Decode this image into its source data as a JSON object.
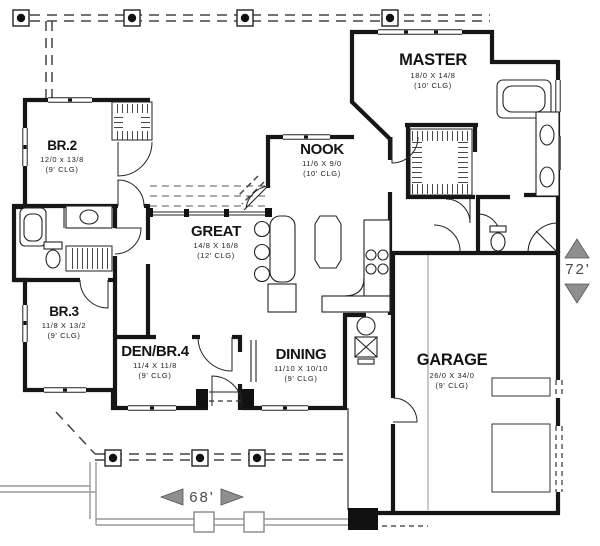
{
  "rooms": [
    {
      "id": "master",
      "name": "MASTER",
      "dims": "18/0 X 14/8",
      "clg": "(10' CLG)"
    },
    {
      "id": "nook",
      "name": "NOOK",
      "dims": "11/6 X 9/0",
      "clg": "(10' CLG)"
    },
    {
      "id": "br2",
      "name": "BR.2",
      "dims": "12/0 x 13/8",
      "clg": "(9' CLG)"
    },
    {
      "id": "great",
      "name": "GREAT",
      "dims": "14/8 X 16/8",
      "clg": "(12' CLG)"
    },
    {
      "id": "br3",
      "name": "BR.3",
      "dims": "11/8 X 13/2",
      "clg": "(9' CLG)"
    },
    {
      "id": "den",
      "name": "DEN/BR.4",
      "dims": "11/4 X 11/8",
      "clg": "(9' CLG)"
    },
    {
      "id": "dining",
      "name": "DINING",
      "dims": "11/10 X 10/10",
      "clg": "(9' CLG)"
    },
    {
      "id": "garage",
      "name": "GARAGE",
      "dims": "26/0 X 34/0",
      "clg": "(9' CLG)"
    }
  ],
  "plan_dimensions": {
    "width": "68'",
    "depth": "72'"
  },
  "colors": {
    "wall": "#161616",
    "detail": "#222222",
    "dashed": "#444444",
    "walkway": "#9a9a9a",
    "dim_arrow": "#8f8f8f",
    "paper": "#ffffff"
  }
}
